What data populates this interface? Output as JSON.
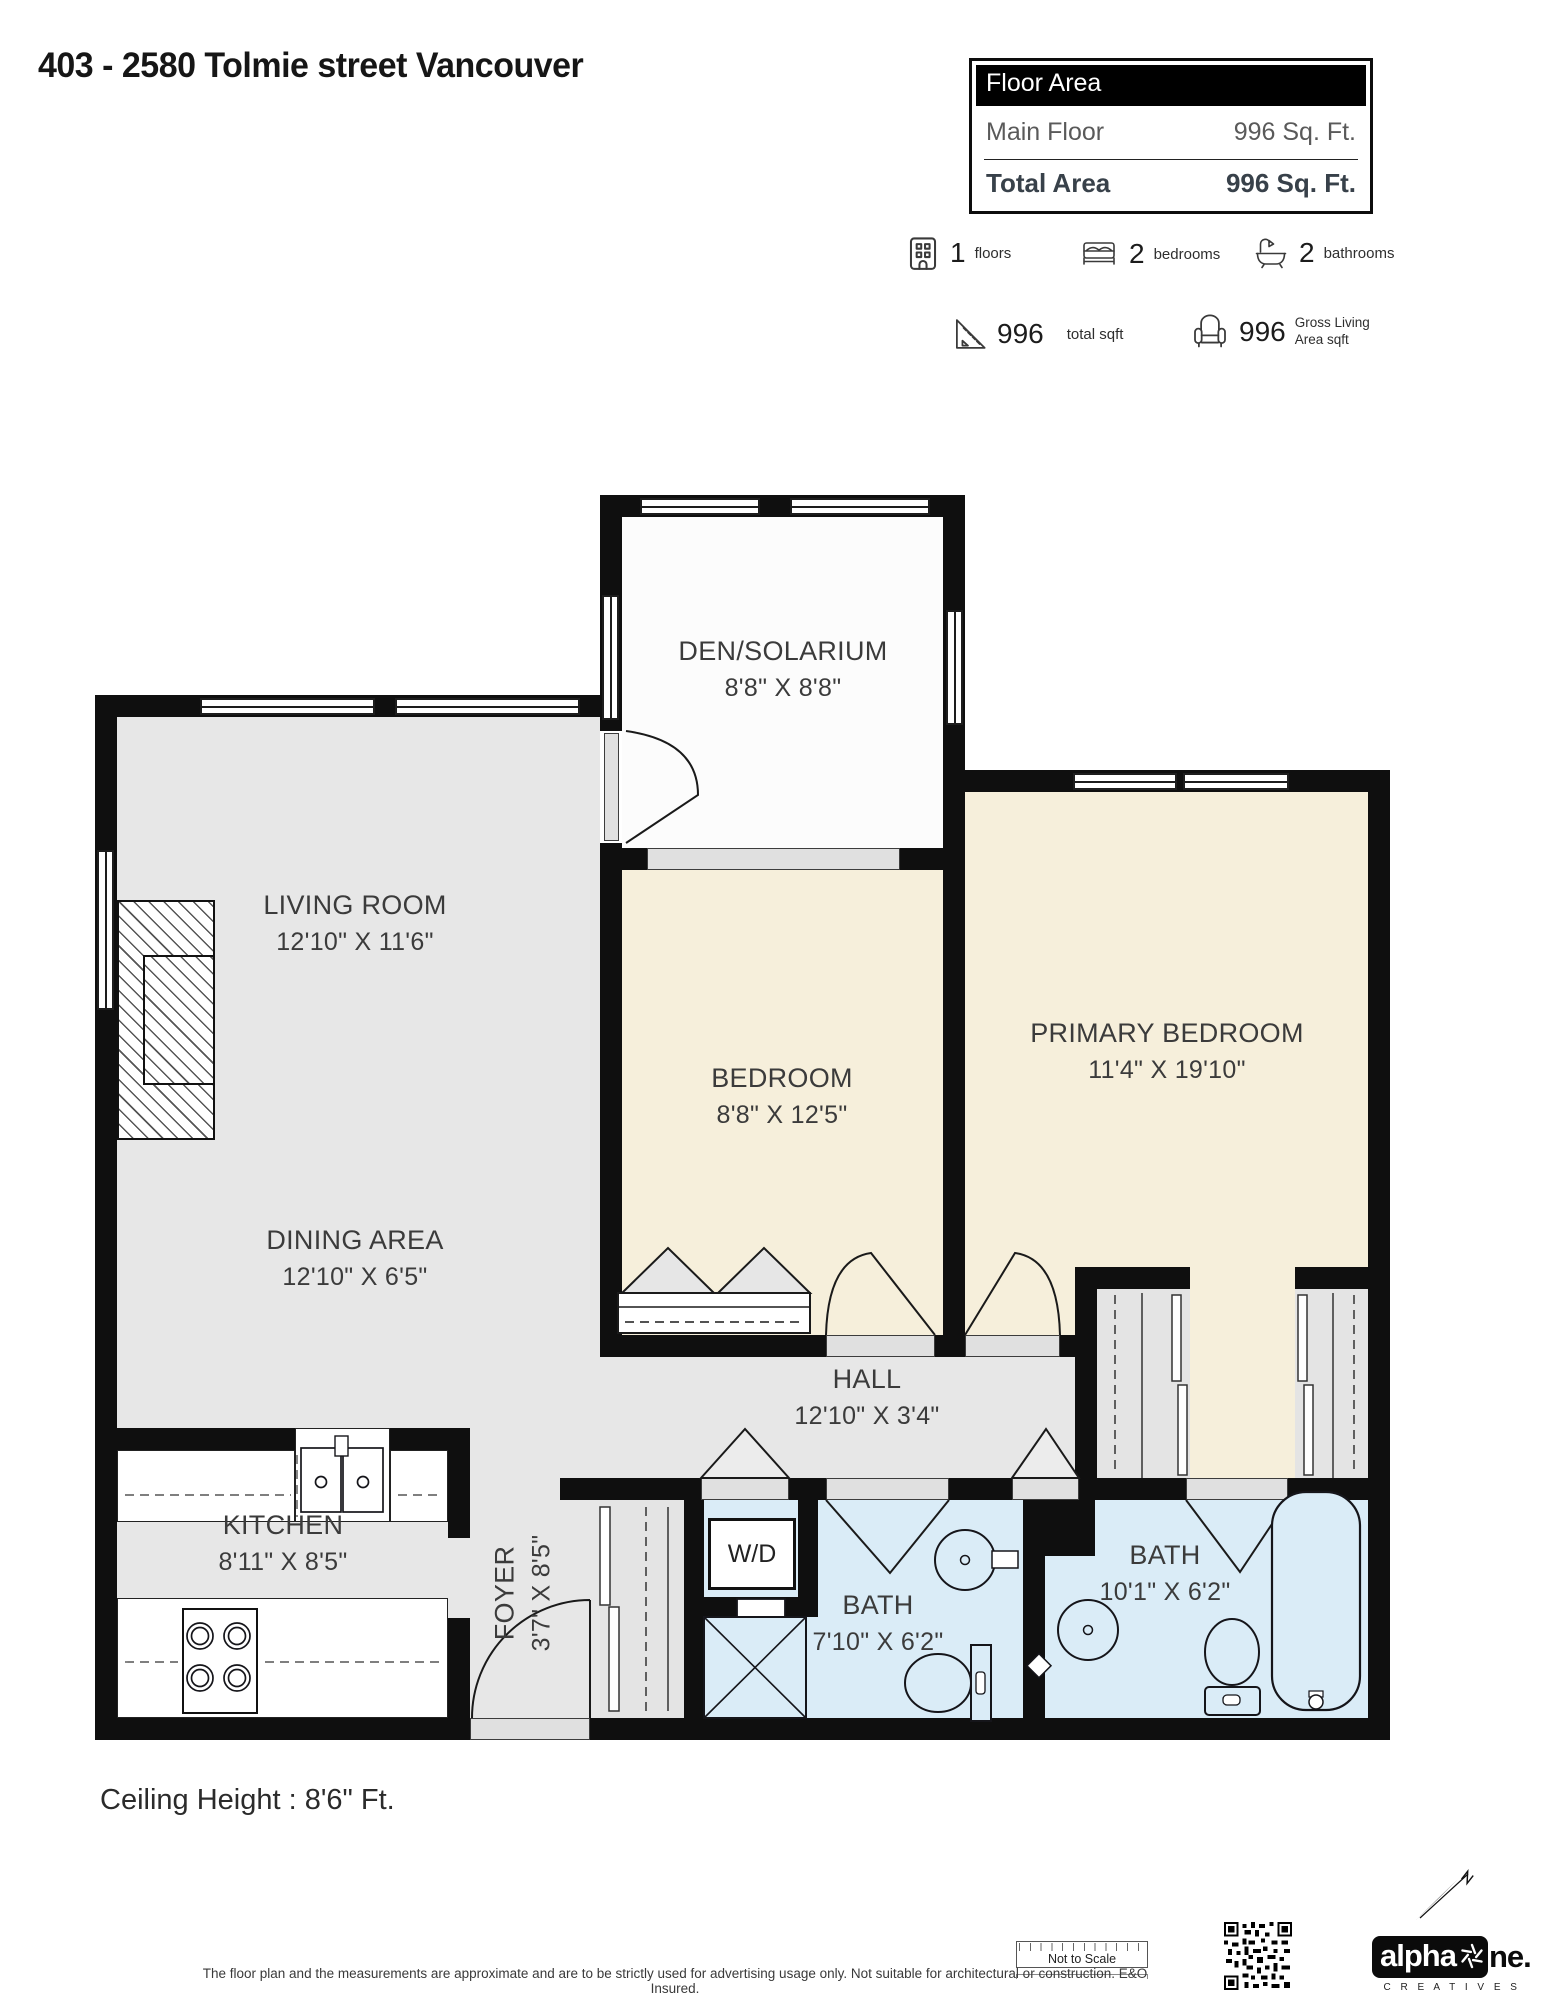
{
  "header": {
    "title": "403 - 2580 Tolmie street Vancouver",
    "floor_area": {
      "header": "Floor Area",
      "main_label": "Main Floor",
      "main_value": "996 Sq. Ft.",
      "total_label": "Total Area",
      "total_value": "996 Sq. Ft."
    },
    "stats": [
      {
        "value": "1",
        "label": "floors"
      },
      {
        "value": "2",
        "label": "bedrooms"
      },
      {
        "value": "2",
        "label": "bathrooms"
      },
      {
        "value": "996",
        "label": "total sqft"
      },
      {
        "value": "996",
        "label": "Gross Living Area sqft"
      }
    ]
  },
  "plan": {
    "rooms": [
      {
        "name": "DEN/SOLARIUM",
        "dims": "8'8\" X 8'8\""
      },
      {
        "name": "LIVING ROOM",
        "dims": "12'10\" X 11'6\""
      },
      {
        "name": "DINING AREA",
        "dims": "12'10\" X 6'5\""
      },
      {
        "name": "BEDROOM",
        "dims": "8'8\" X 12'5\""
      },
      {
        "name": "PRIMARY BEDROOM",
        "dims": "11'4\" X 19'10\""
      },
      {
        "name": "HALL",
        "dims": "12'10\" X 3'4\""
      },
      {
        "name": "KITCHEN",
        "dims": "8'11\" X 8'5\""
      },
      {
        "name": "FOYER",
        "dims": "3'7\" X 8'5\""
      },
      {
        "name": "BATH",
        "dims": "7'10\" X 6'2\""
      },
      {
        "name": "BATH",
        "dims": "10'1\" X 6'2\""
      }
    ],
    "wd_label": "W/D",
    "colors": {
      "wall": "#0f0f0f",
      "floor_gray": "#e7e7e7",
      "floor_beige": "#f6efdb",
      "floor_blue": "#daecf7"
    }
  },
  "footer": {
    "ceiling_height": "Ceiling Height : 8'6\" Ft.",
    "scale_note": "Not to Scale",
    "disclaimer": "The floor plan and the measurements are approximate and are to be strictly used for advertising usage only.  Not suitable for architectural or construction. E&O Insured.",
    "logo_part1": "alpha",
    "logo_part2": "ne.",
    "logo_sub": "C R E A T I V E S"
  }
}
